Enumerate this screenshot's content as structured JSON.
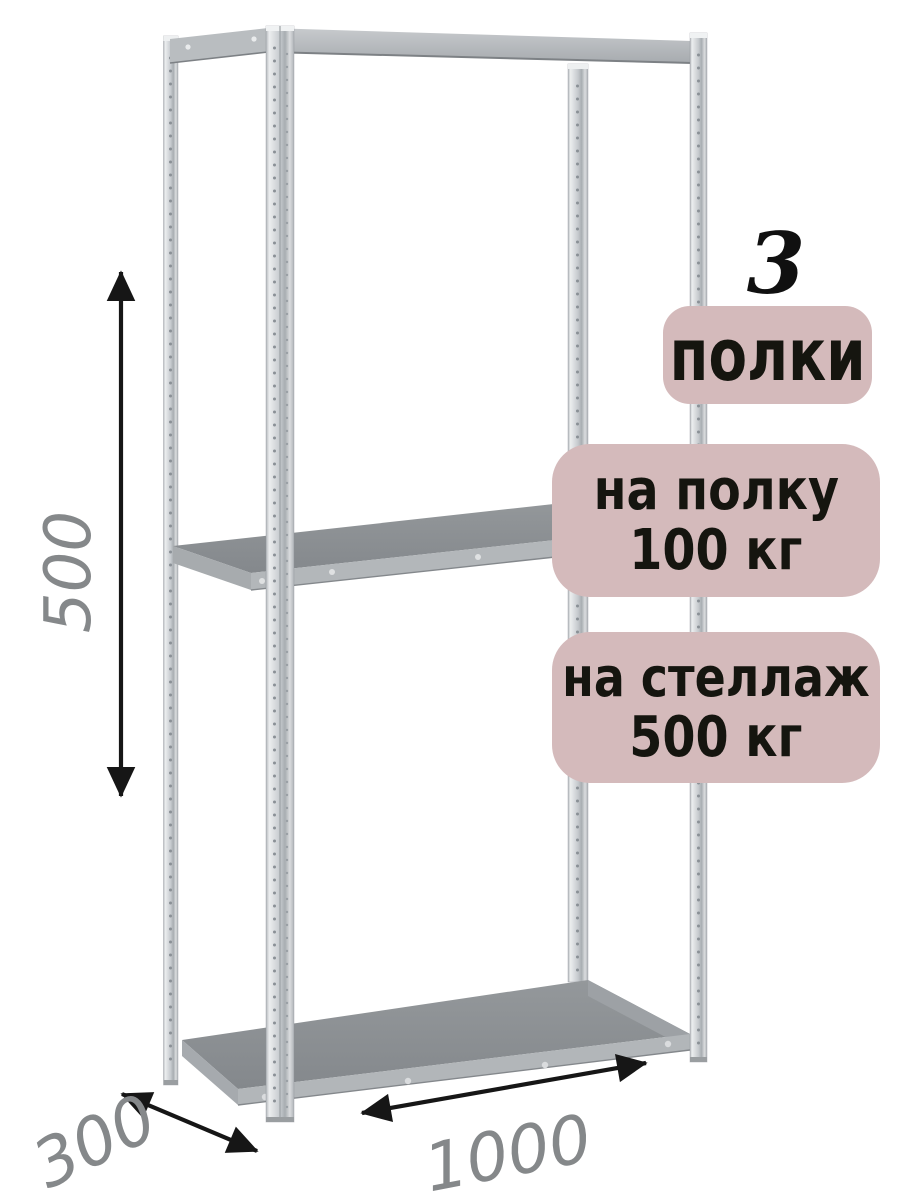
{
  "annotations": {
    "shelf_count_number": "3",
    "badge_shelves_label": "полки",
    "badge_per_shelf": {
      "line1": "на полку",
      "line2": "100 кг"
    },
    "badge_per_rack": {
      "line1": "на стеллаж",
      "line2": "500 кг"
    },
    "dim_height": "500",
    "dim_depth": "300",
    "dim_width": "1000"
  },
  "colors": {
    "background": "#ffffff",
    "badge_bg": "#d4babb",
    "badge_text": "#15150f",
    "dimension_text": "#85888a",
    "arrow": "#161616",
    "shelf_top": "#8c9094",
    "frame_metal": "#c9cdd1"
  }
}
